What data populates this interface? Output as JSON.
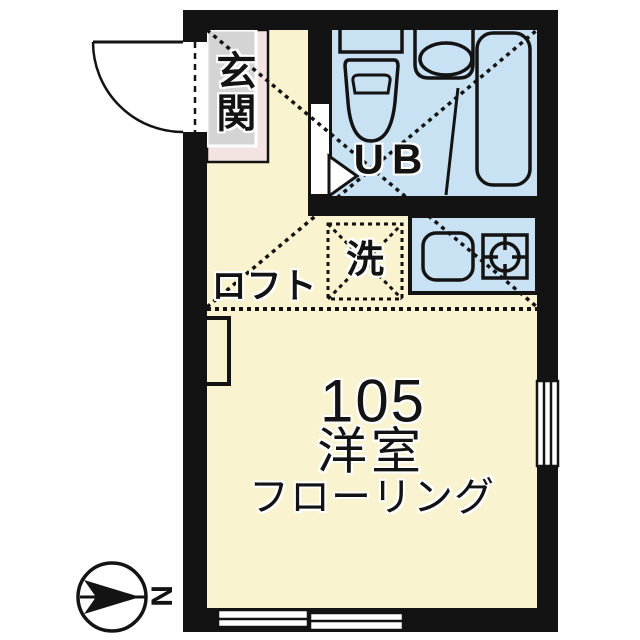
{
  "plan": {
    "unit_number": "105",
    "room_label": "洋室",
    "floor_label": "フローリング",
    "entrance_label": "玄関",
    "unit_bath_label": "UB",
    "washing_machine_label": "洗",
    "loft_label": "ロフト",
    "compass_label": "N"
  },
  "colors": {
    "room_floor": "#FAF3CF",
    "wet_area": "#C9E2F3",
    "entrance_floor": "#D4D4D4",
    "entrance_step": "#F4E4E1",
    "ink": "#131313"
  }
}
